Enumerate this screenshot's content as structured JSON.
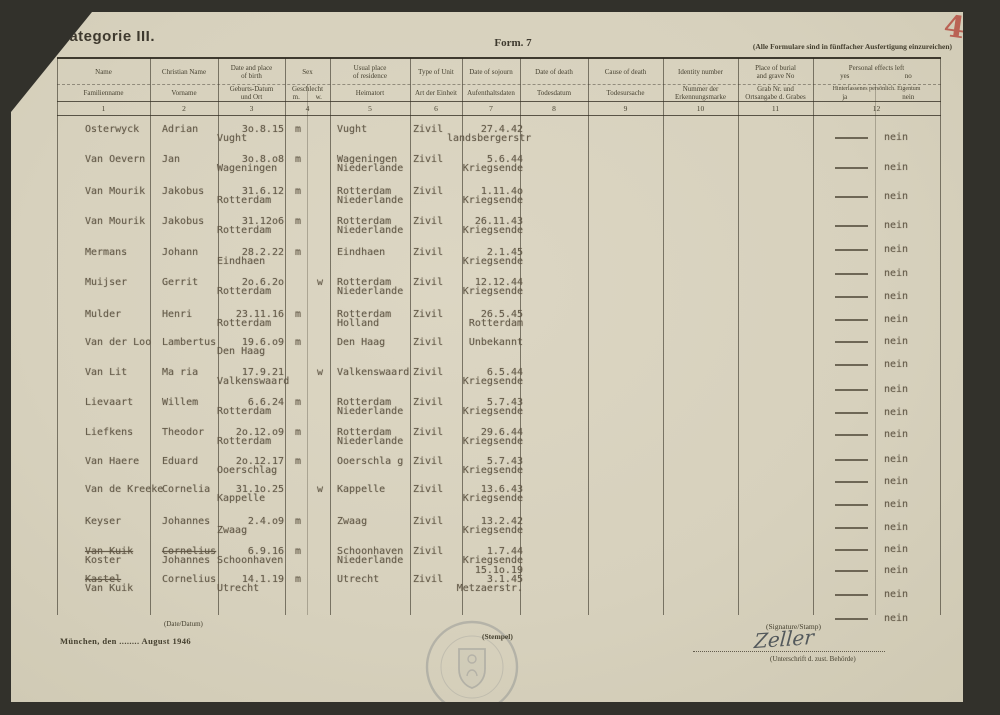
{
  "page": {
    "number_label": "4"
  },
  "title": "Kategorie III.",
  "form_label": "Form. 7",
  "copies_note": "(Alle Formulare sind in fünffacher Ausfertigung einzureichen)",
  "table": {
    "columns": [
      {
        "en": [
          "Name"
        ],
        "de": [
          "Familienname"
        ],
        "num": "1"
      },
      {
        "en": [
          "Christian Name"
        ],
        "de": [
          "Vorname"
        ],
        "num": "2"
      },
      {
        "en": [
          "Date and place",
          "of birth"
        ],
        "de": [
          "Geburts-Datum",
          "und Ort"
        ],
        "num": "3"
      },
      {
        "en": [
          "Sex"
        ],
        "de": [
          "Geschlecht"
        ],
        "de_sub": [
          "m.",
          "w."
        ],
        "num": "4"
      },
      {
        "en": [
          "Usual place",
          "of residence"
        ],
        "de": [
          "Heimatort"
        ],
        "num": "5"
      },
      {
        "en": [
          "Type of Unit"
        ],
        "de": [
          "Art der Einheit"
        ],
        "num": "6"
      },
      {
        "en": [
          "Date of sojourn"
        ],
        "de": [
          "Aufenthaltsdaten"
        ],
        "num": "7"
      },
      {
        "en": [
          "Date of death"
        ],
        "de": [
          "Todesdatum"
        ],
        "num": "8"
      },
      {
        "en": [
          "Cause of death"
        ],
        "de": [
          "Todesursache"
        ],
        "num": "9"
      },
      {
        "en": [
          "Identity number"
        ],
        "de": [
          "Nummer der",
          "Erkennungsmarke"
        ],
        "num": "10"
      },
      {
        "en": [
          "Place of burial",
          "and grave No"
        ],
        "de": [
          "Grab Nr. und",
          "Ortsangabe d. Grabes"
        ],
        "num": "11"
      },
      {
        "en": [
          "Personal effects left"
        ],
        "en_sub": [
          "yes",
          "no"
        ],
        "de": [
          "Hinterlassenes persönlich. Eigentum"
        ],
        "de_sub": [
          "ja",
          "nein"
        ],
        "num": "12"
      }
    ],
    "rows": [
      {
        "name": "Osterwyck",
        "christian": "Adrian",
        "birth_date": "3o.8.15",
        "birth_place": "Vught",
        "sex": "m",
        "residence": "Vught",
        "unit": "Zivil",
        "capture1": "27.4.42",
        "capture2": "landsbergerstr"
      },
      {
        "name": "Van Oevern",
        "christian": "Jan",
        "birth_date": "3o.8.o8",
        "birth_place": "Wageningen",
        "sex": "m",
        "residence": "Wageningen",
        "residence2": "Niederlande",
        "unit": "Zivil",
        "capture1": "5.6.44",
        "capture2": "Kriegsende"
      },
      {
        "name": "Van Mourik",
        "christian": "Jakobus",
        "birth_date": "31.6.12",
        "birth_place": "Rotterdam",
        "sex": "m",
        "residence": "Rotterdam",
        "residence2": "Niederlande",
        "unit": "Zivil",
        "capture1": "1.11.4o",
        "capture2": "Kriegsende"
      },
      {
        "name": "Van Mourik",
        "christian": "Jakobus",
        "birth_date": "31.12o6",
        "birth_place": "Rotterdam",
        "sex": "m",
        "residence": "Rotterdam",
        "residence2": "Niederlande",
        "unit": "Zivil",
        "capture1": "26.11.43",
        "capture2": "Kriegsende"
      },
      {
        "name": "Mermans",
        "christian": "Johann",
        "birth_date": "28.2.22",
        "birth_place": "Eindhaen",
        "sex": "m",
        "residence": "Eindhaen",
        "unit": "Zivil",
        "capture1": "2.1.45",
        "capture2": "Kriegsende"
      },
      {
        "name": "Muijser",
        "christian": "Gerrit",
        "birth_date": "2o.6.2o",
        "birth_place": "Rotterdam",
        "sex": "w",
        "residence": "Rotterdam",
        "residence2": "Niederlande",
        "unit": "Zivil",
        "capture1": "12.12.44",
        "capture2": "Kriegsende"
      },
      {
        "name": "Mulder",
        "christian": "Henri",
        "birth_date": "23.11.16",
        "birth_place": "Rotterdam",
        "sex": "m",
        "residence": "Rotterdam",
        "residence2": "Holland",
        "unit": "Zivil",
        "capture1": "26.5.45",
        "capture2": "Rotterdam"
      },
      {
        "name": "Van der Loo",
        "christian": "Lambertus",
        "birth_date": "19.6.o9",
        "birth_place": "Den Haag",
        "sex": "m",
        "residence": "Den Haag",
        "unit": "Zivil",
        "capture1": "Unbekannt"
      },
      {
        "name": "Van Lit",
        "christian": "Ma ria",
        "birth_date": "17.9.21",
        "birth_place": "Valkenswaard",
        "sex": "w",
        "residence": "Valkenswaard",
        "unit": "Zivil",
        "capture1": "6.5.44",
        "capture2": "Kriegsende"
      },
      {
        "name": "Lievaart",
        "christian": "Willem",
        "birth_date": "6.6.24",
        "birth_place": "Rotterdam",
        "sex": "m",
        "residence": "Rotterdam",
        "residence2": "Niederlande",
        "unit": "Zivil",
        "capture1": "5.7.43",
        "capture2": "Kriegsende"
      },
      {
        "name": "Liefkens",
        "christian": "Theodor",
        "birth_date": "2o.12.o9",
        "birth_place": "Rotterdam",
        "sex": "m",
        "residence": "Rotterdam",
        "residence2": "Niederlande",
        "unit": "Zivil",
        "capture1": "29.6.44",
        "capture2": "Kriegsende"
      },
      {
        "name": "Van Haere",
        "christian": "Eduard",
        "birth_date": "2o.12.17",
        "birth_place": "Ooerschlag",
        "sex": "m",
        "residence": "Ooerschla g",
        "unit": "Zivil",
        "capture1": "5.7.43",
        "capture2": "Kriegsende"
      },
      {
        "name": "Van de Kreeke",
        "christian": "Cornelia",
        "birth_date": "31.1o.25",
        "birth_place": "Kappelle",
        "sex": "w",
        "residence": "Kappelle",
        "unit": "Zivil",
        "capture1": "13.6.43",
        "capture2": "Kriegsende"
      },
      {
        "name": "Keyser",
        "christian": "Johannes",
        "birth_date": "2.4.o9",
        "birth_place": "Zwaag",
        "sex": "m",
        "residence": "Zwaag",
        "unit": "Zivil",
        "capture1": "13.2.42",
        "capture2": "Kriegsende"
      },
      {
        "name": "Van Kuik",
        "name_struck": true,
        "name2": "Koster",
        "christian": "Cornelius",
        "christian_struck": true,
        "christian2": "Johannes",
        "birth_date": "6.9.16",
        "birth_place": "Schoonhaven",
        "sex": "m",
        "residence": "Schoonhaven",
        "residence2": "Niederlande",
        "unit": "Zivil",
        "capture1": "1.7.44",
        "capture2": "Kriegsende"
      },
      {
        "name": "Kastel",
        "name_struck": true,
        "name2": "Van Kuik",
        "christian": "Cornelius",
        "birth_date": "14.1.19",
        "birth_place": "Utrecht",
        "sex": "m",
        "residence": "Utrecht",
        "unit": "Zivil",
        "capture0": "15.1o.19",
        "capture1": "3.1.45",
        "capture2": "Metzaerstr."
      }
    ],
    "personal_effects_entries": [
      "nein",
      "nein",
      "nein",
      "nein",
      "nein",
      "nein",
      "nein",
      "nein",
      "nein",
      "nein",
      "nein",
      "nein",
      "nein",
      "nein",
      "nein",
      "nein",
      "nein",
      "nein",
      "nein",
      "nein",
      "nein"
    ]
  },
  "footer": {
    "date_label": "(Date/Datum)",
    "date_line": "München, den ........ August 1946",
    "stamp_label": "(Stempel)",
    "signature_label": "(Signature/Stamp)",
    "signature": "Zeller",
    "signature_sub": "(Unterschrift d. zust. Behörde)"
  }
}
